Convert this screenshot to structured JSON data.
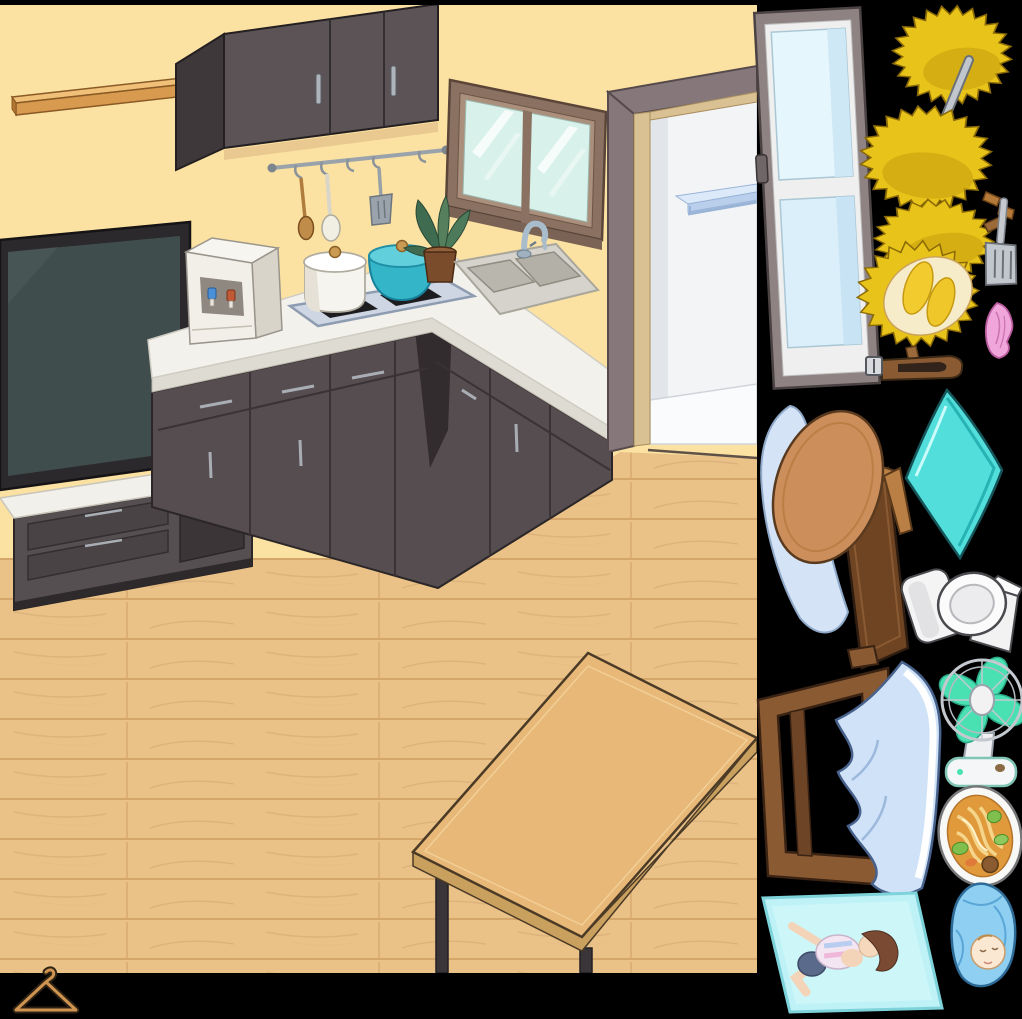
{
  "canvas": {
    "width": 1022,
    "height": 1019,
    "background": "#000000"
  },
  "colors": {
    "wall": "#fbe2a2",
    "floor": "#eac288",
    "floor_line": "#cf9f63",
    "cabinet_dark": "#554d50",
    "countertop": "#f3f1eb",
    "tv_screen": "#3f4d4d",
    "teal_pot": "#35b5c8",
    "door_interior": "#f3f4f6",
    "table_wood": "#e7b877",
    "durian_yellow": "#e8c319",
    "towel_cyan": "#52dfdb",
    "blanket_blue": "#cfe2f7",
    "mat_cyan": "#bff2f7",
    "swaddle_blue": "#8fd0f2",
    "fan_blade": "#49e0b2",
    "hanger_wood": "#cf9450"
  },
  "scene": {
    "objects": [
      {
        "id": "wall-shelf",
        "label": "wooden wall shelf"
      },
      {
        "id": "upper-cabinet",
        "label": "dark wall cabinet"
      },
      {
        "id": "utensil-rail",
        "label": "hanging rail with wooden spoon, ladle and spatula"
      },
      {
        "id": "window",
        "label": "kitchen window"
      },
      {
        "id": "plant",
        "label": "potted plant"
      },
      {
        "id": "doorway",
        "label": "open doorway with blue shelf"
      },
      {
        "id": "tv",
        "label": "wall mounted television"
      },
      {
        "id": "tv-stand",
        "label": "television stand"
      },
      {
        "id": "kitchen-counter",
        "label": "L-shaped kitchen counter"
      },
      {
        "id": "water-dispenser",
        "label": "water dispenser with hot and cold taps"
      },
      {
        "id": "cooktop",
        "label": "induction cooktop with white pot and teal pot"
      },
      {
        "id": "sink",
        "label": "double basin sink with faucet"
      },
      {
        "id": "dining-table",
        "label": "wooden dining table"
      }
    ]
  },
  "sidebar": {
    "background": "#000000",
    "items": [
      {
        "id": "glass-door",
        "label": "gray framed glass door"
      },
      {
        "id": "durian-skewer",
        "label": "two durians on a metal rod"
      },
      {
        "id": "durian",
        "label": "whole durian"
      },
      {
        "id": "spatula",
        "label": "metal slotted spatula"
      },
      {
        "id": "open-durian",
        "label": "opened durian showing flesh"
      },
      {
        "id": "pink-cloth",
        "label": "crumpled pink cloth"
      },
      {
        "id": "belt",
        "label": "brown leather belt"
      },
      {
        "id": "ironing-board",
        "label": "folded ironing board with pad"
      },
      {
        "id": "cyan-towel",
        "label": "cyan blanket"
      },
      {
        "id": "toilet",
        "label": "white toilet on its side"
      },
      {
        "id": "bed",
        "label": "wooden bed with blue bedding"
      },
      {
        "id": "fan",
        "label": "desk fan with green blades"
      },
      {
        "id": "noodle-bowl",
        "label": "bowl of noodle soup"
      },
      {
        "id": "exercise-mat",
        "label": "person lying on cyan mat"
      },
      {
        "id": "swaddled-baby",
        "label": "baby swaddled in blue blanket"
      },
      {
        "id": "clothes-hanger",
        "label": "wooden clothes hanger"
      }
    ]
  }
}
